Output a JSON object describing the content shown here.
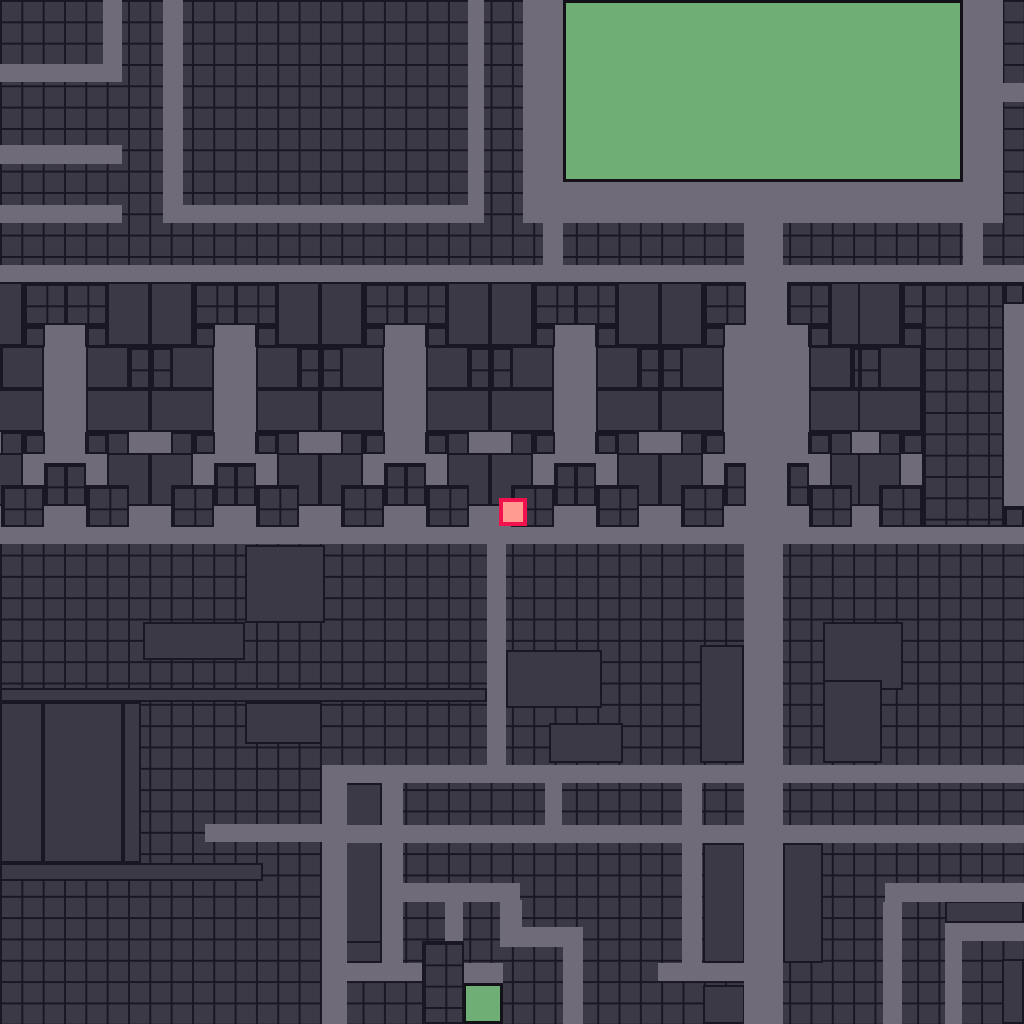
{
  "meta": {
    "view": "tile-city-map",
    "width_px": 1024,
    "height_px": 1024,
    "tile_px": 21.33
  },
  "colors": {
    "cell_fill": "#3c3946",
    "grid_line": "#191722",
    "road": "#6f6b78",
    "park_fill": "#6fae74",
    "park_border": "#141118",
    "marker_fill": "#ff9b90",
    "marker_border": "#f2114f"
  },
  "map_data": {
    "type": "tile-city-map",
    "roads": [
      [
        0,
        64,
        122,
        18
      ],
      [
        103,
        0,
        19,
        64
      ],
      [
        0,
        145,
        122,
        19
      ],
      [
        163,
        0,
        20,
        223
      ],
      [
        0,
        205,
        122,
        18
      ],
      [
        183,
        205,
        285,
        18
      ],
      [
        468,
        0,
        16,
        223
      ],
      [
        523,
        0,
        40,
        223
      ],
      [
        543,
        223,
        20,
        42
      ],
      [
        523,
        182,
        480,
        41
      ],
      [
        963,
        0,
        40,
        182
      ],
      [
        1003,
        83,
        21,
        19
      ],
      [
        963,
        223,
        20,
        59
      ],
      [
        0,
        265,
        1024,
        17
      ],
      [
        0,
        282,
        1024,
        245
      ],
      [
        0,
        527,
        1024,
        17
      ],
      [
        744,
        182,
        39,
        842
      ],
      [
        487,
        544,
        19,
        221
      ],
      [
        322,
        765,
        702,
        18
      ],
      [
        322,
        765,
        25,
        259
      ],
      [
        205,
        824,
        117,
        18
      ],
      [
        345,
        825,
        679,
        18
      ],
      [
        382,
        783,
        21,
        180
      ],
      [
        545,
        783,
        17,
        42
      ],
      [
        682,
        765,
        20,
        216
      ],
      [
        658,
        963,
        125,
        18
      ],
      [
        403,
        883,
        117,
        19
      ],
      [
        445,
        883,
        18,
        100
      ],
      [
        500,
        900,
        22,
        47
      ],
      [
        500,
        927,
        83,
        20
      ],
      [
        563,
        927,
        20,
        97
      ],
      [
        462,
        963,
        41,
        20
      ],
      [
        322,
        963,
        141,
        18
      ],
      [
        885,
        883,
        139,
        19
      ],
      [
        883,
        902,
        19,
        122
      ],
      [
        945,
        923,
        79,
        18
      ],
      [
        945,
        941,
        17,
        83
      ]
    ],
    "buildings": [
      [
        245,
        545,
        80,
        78
      ],
      [
        143,
        622,
        102,
        38
      ],
      [
        0,
        688,
        487,
        14
      ],
      [
        506,
        688,
        40,
        14
      ],
      [
        823,
        622,
        80,
        68
      ],
      [
        823,
        680,
        59,
        83
      ],
      [
        703,
        680,
        21,
        83
      ],
      [
        724,
        680,
        21,
        83
      ],
      [
        0,
        702,
        43,
        161
      ],
      [
        43,
        702,
        80,
        161
      ],
      [
        123,
        702,
        18,
        161
      ],
      [
        245,
        702,
        77,
        42
      ],
      [
        0,
        863,
        263,
        18
      ],
      [
        345,
        783,
        37,
        180
      ],
      [
        343,
        941,
        39,
        22
      ],
      [
        506,
        650,
        96,
        58
      ],
      [
        549,
        723,
        74,
        40
      ],
      [
        700,
        645,
        44,
        118
      ],
      [
        703,
        843,
        42,
        120
      ],
      [
        783,
        843,
        40,
        120
      ],
      [
        703,
        985,
        42,
        39
      ],
      [
        945,
        901,
        79,
        22
      ],
      [
        1002,
        959,
        22,
        65
      ],
      [
        1003,
        361,
        21,
        64
      ]
    ],
    "cell_patches": [
      [
        922,
        282,
        82,
        245
      ],
      [
        1003,
        282,
        21,
        22
      ],
      [
        1003,
        506,
        21,
        21
      ],
      [
        422,
        941,
        42,
        83
      ]
    ],
    "houses": {
      "band_y": 282,
      "band_h": 245,
      "col_w": 85,
      "columns": [
        {
          "x": -20,
          "flip": false
        },
        {
          "x": 65,
          "flip": true
        },
        {
          "x": 150,
          "flip": false
        },
        {
          "x": 235,
          "flip": true
        },
        {
          "x": 320,
          "flip": false
        },
        {
          "x": 405,
          "flip": true
        },
        {
          "x": 490,
          "flip": false
        },
        {
          "x": 575,
          "flip": true
        },
        {
          "x": 660,
          "flip": false
        },
        {
          "x": 788,
          "flip": true
        },
        {
          "x": 858,
          "flip": false
        }
      ],
      "motif": [
        {
          "t": "rect",
          "x": 0,
          "y": 0,
          "w": 43,
          "h": 64
        },
        {
          "t": "cells",
          "x": 43,
          "y": 0,
          "w": 43,
          "h": 43
        },
        {
          "t": "cells",
          "x": 43,
          "y": 43,
          "w": 22,
          "h": 22
        },
        {
          "t": "rect",
          "x": 21,
          "y": 64,
          "w": 43,
          "h": 43
        },
        {
          "t": "cells",
          "x": 0,
          "y": 64,
          "w": 22,
          "h": 43
        },
        {
          "t": "rect",
          "x": 0,
          "y": 107,
          "w": 64,
          "h": 43
        },
        {
          "t": "cells",
          "x": 43,
          "y": 150,
          "w": 22,
          "h": 22
        },
        {
          "t": "rect",
          "x": 21,
          "y": 150,
          "w": 22,
          "h": 43
        },
        {
          "t": "rect",
          "x": 0,
          "y": 171,
          "w": 43,
          "h": 53
        },
        {
          "t": "cells",
          "x": 21,
          "y": 203,
          "w": 43,
          "h": 42
        },
        {
          "t": "cells",
          "x": 64,
          "y": 181,
          "w": 22,
          "h": 43
        }
      ]
    },
    "parks": [
      [
        563,
        0,
        400,
        182
      ],
      [
        463,
        983,
        40,
        41
      ]
    ],
    "marker": {
      "x": 499,
      "y": 498,
      "w": 28,
      "h": 28
    }
  }
}
